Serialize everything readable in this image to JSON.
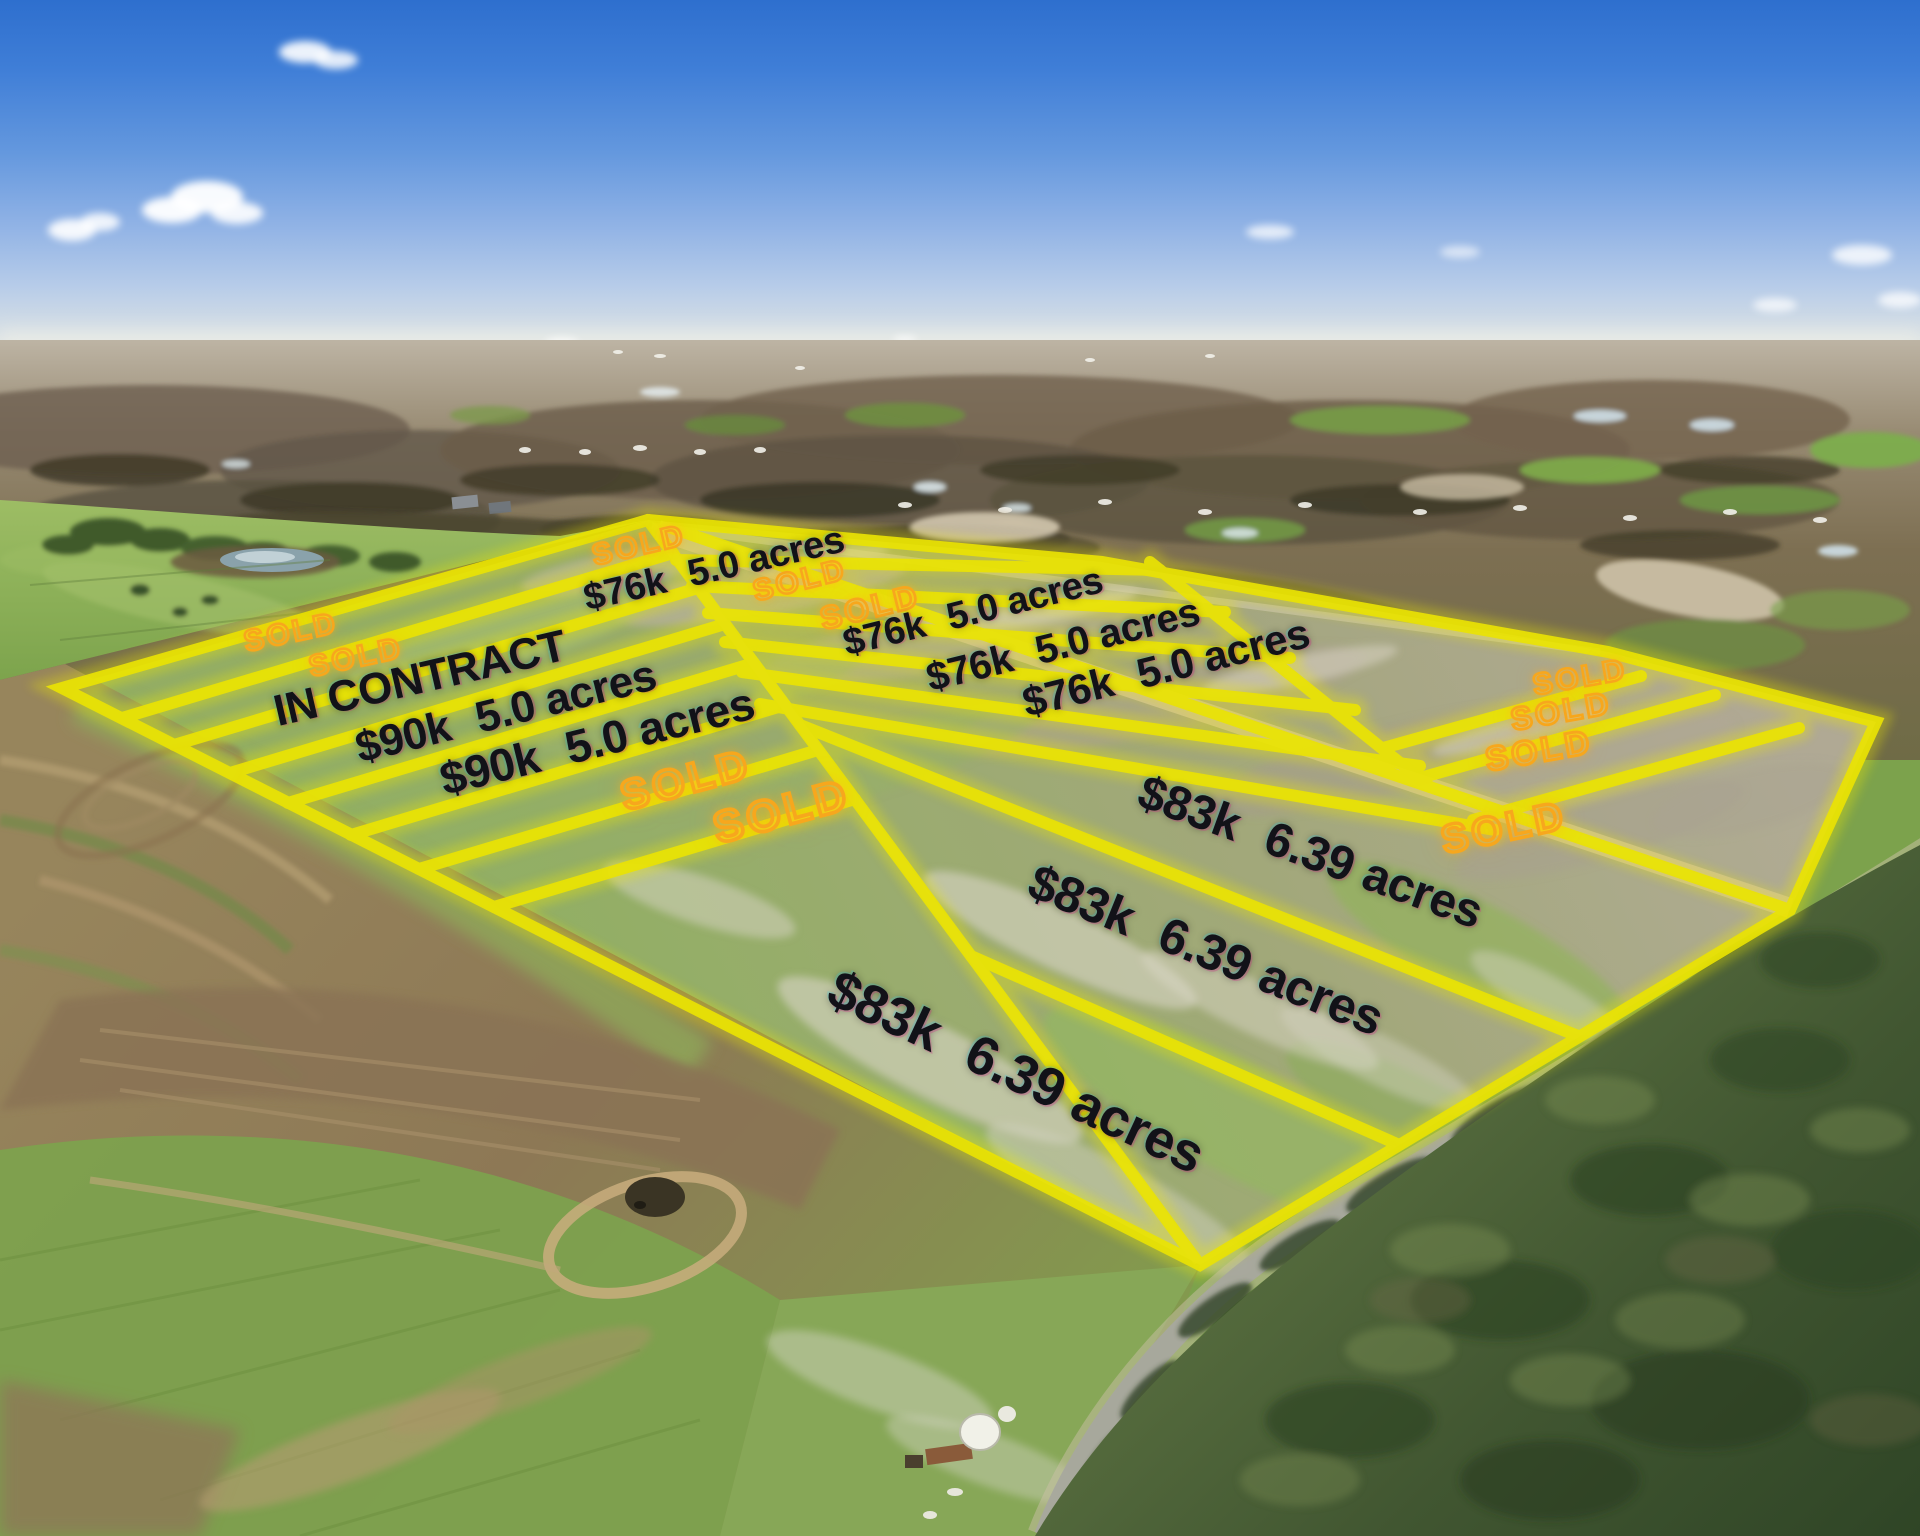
{
  "colors": {
    "lot_line_yellow": "#eae304",
    "lot_line_glow": "#f0ea00",
    "sold_orange": "#f7a71d",
    "price_text_black": "#121218",
    "sky_top": "#3072d0",
    "sky_horizon": "#eceee8",
    "road_tan": "#cfc0a4",
    "forest_green": "#3c5128"
  },
  "lot_labels": {
    "sold_text": "SOLD",
    "in_contract_text": "IN CONTRACT",
    "in_contract": {
      "x": 420,
      "y": 679,
      "rot": -13,
      "size": 44
    },
    "sold_positions": [
      {
        "x": 639,
        "y": 546,
        "rot": -13,
        "size": 30
      },
      {
        "x": 800,
        "y": 581,
        "rot": -14,
        "size": 30
      },
      {
        "x": 870,
        "y": 607,
        "rot": -14,
        "size": 32
      },
      {
        "x": 291,
        "y": 633,
        "rot": -12,
        "size": 30
      },
      {
        "x": 356,
        "y": 658,
        "rot": -12,
        "size": 30
      },
      {
        "x": 686,
        "y": 780,
        "rot": -15,
        "size": 42
      },
      {
        "x": 782,
        "y": 812,
        "rot": -15,
        "size": 44
      },
      {
        "x": 1580,
        "y": 678,
        "rot": -10,
        "size": 30
      },
      {
        "x": 1561,
        "y": 711,
        "rot": -10,
        "size": 32
      },
      {
        "x": 1539,
        "y": 751,
        "rot": -10,
        "size": 34
      },
      {
        "x": 1504,
        "y": 828,
        "rot": -12,
        "size": 40
      }
    ],
    "price_positions": [
      {
        "price": "$76k",
        "acres": "5.0 acres",
        "x": 714,
        "y": 569,
        "rot": -13,
        "size": 38
      },
      {
        "price": "$76k",
        "acres": "5.0 acres",
        "x": 973,
        "y": 612,
        "rot": -14,
        "size": 38
      },
      {
        "price": "$76k",
        "acres": "5.0 acres",
        "x": 1063,
        "y": 645,
        "rot": -14,
        "size": 40
      },
      {
        "price": "$76k",
        "acres": "5.0 acres",
        "x": 1166,
        "y": 668,
        "rot": -14,
        "size": 42
      },
      {
        "price": "$90k",
        "acres": "5.0 acres",
        "x": 506,
        "y": 712,
        "rot": -14,
        "size": 44
      },
      {
        "price": "$90k",
        "acres": "5.0 acres",
        "x": 597,
        "y": 741,
        "rot": -14,
        "size": 46
      },
      {
        "price": "$83k",
        "acres": "6.39 acres",
        "x": 1310,
        "y": 853,
        "rot": 20,
        "size": 48
      },
      {
        "price": "$83k",
        "acres": "6.39 acres",
        "x": 1206,
        "y": 950,
        "rot": 22,
        "size": 50
      },
      {
        "price": "$83k",
        "acres": "6.39 acres",
        "x": 1016,
        "y": 1072,
        "rot": 25,
        "size": 54
      }
    ]
  },
  "lot_lines": {
    "boundary": [
      [
        62,
        688
      ],
      [
        648,
        520
      ],
      [
        1102,
        562
      ],
      [
        1608,
        652
      ],
      [
        1876,
        722
      ],
      [
        1790,
        910
      ],
      [
        1200,
        1265
      ]
    ],
    "segments": [
      [
        122,
        718,
        673,
        553
      ],
      [
        174,
        745,
        698,
        588
      ],
      [
        230,
        773,
        725,
        624
      ],
      [
        288,
        803,
        754,
        663
      ],
      [
        351,
        835,
        785,
        705
      ],
      [
        419,
        869,
        818,
        750
      ],
      [
        494,
        907,
        855,
        799
      ],
      [
        676,
        560,
        1160,
        570
      ],
      [
        692,
        586,
        1225,
        612
      ],
      [
        708,
        613,
        1290,
        658
      ],
      [
        725,
        642,
        1355,
        710
      ],
      [
        742,
        672,
        1420,
        766
      ],
      [
        760,
        704,
        1495,
        830
      ],
      [
        648,
        520,
        1790,
        910
      ],
      [
        648,
        520,
        1200,
        1265
      ],
      [
        1150,
        562,
        1430,
        787
      ],
      [
        1383,
        748,
        1641,
        676
      ],
      [
        1420,
        778,
        1715,
        695
      ],
      [
        1473,
        820,
        1799,
        728
      ],
      [
        800,
        725,
        1578,
        1036
      ],
      [
        971,
        956,
        1397,
        1144
      ]
    ]
  }
}
